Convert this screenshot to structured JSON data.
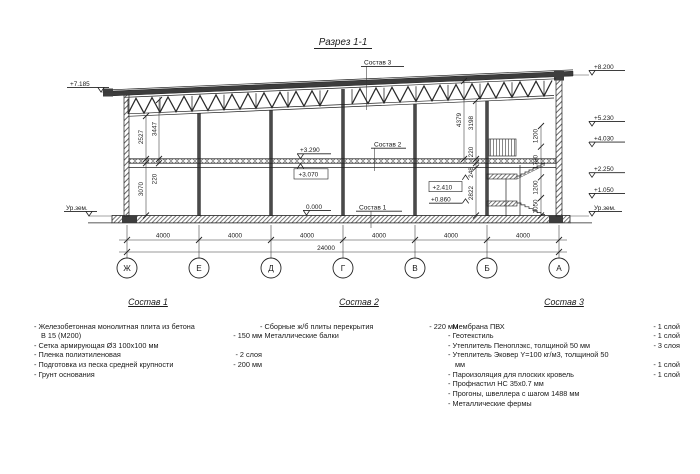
{
  "title": "Разрез 1-1",
  "colors": {
    "line": "#1f1f1f",
    "dark_fill": "#3d3d3d",
    "background": "#ffffff"
  },
  "drawing": {
    "marks": {
      "left_roof": "+7.185",
      "left_ground": "Ур.зем.",
      "right": [
        "+8.200",
        "+5.230",
        "+4.030",
        "+2.250",
        "+1.050",
        "Ур.зем."
      ],
      "slab_top": "+3.290",
      "slab_bottom": "+3.070",
      "floor_zero": "0.000",
      "stair_upper": "+2.410",
      "stair_lower": "+0.860"
    },
    "leader_labels": {
      "sostav1": "Состав 1",
      "sostav2": "Состав 2",
      "sostav3": "Состав 3"
    },
    "dims": {
      "left": [
        "2527",
        "3447",
        "220",
        "3070"
      ],
      "right_inner": [
        "4379",
        "3198",
        "220",
        "248",
        "2822"
      ],
      "right_wall": [
        "1200",
        "1780",
        "1200",
        "1050"
      ],
      "bays": [
        "4000",
        "4000",
        "4000",
        "4000",
        "4000",
        "4000"
      ],
      "total": "24000"
    },
    "axes": [
      "Ж",
      "Е",
      "Д",
      "Г",
      "В",
      "Б",
      "А"
    ]
  },
  "compositions": [
    {
      "title": "Состав 1",
      "items": [
        {
          "text": "- Железобетонная  монолитная плита из бетона В 15 (М200)",
          "value": "- 150 мм"
        },
        {
          "text": "- Сетка армирующая Ø3 100х100 мм",
          "value": ""
        },
        {
          "text": "- Пленка полиэтиленовая",
          "value": "- 2 слоя"
        },
        {
          "text": "- Подготовка из песка средней крупности",
          "value": "- 200 мм"
        },
        {
          "text": "- Грунт основания",
          "value": ""
        }
      ]
    },
    {
      "title": "Состав 2",
      "items": [
        {
          "text": "- Сборные ж/б плиты перекрытия",
          "value": "- 220 мм"
        },
        {
          "text": "- Металлические балки",
          "value": ""
        }
      ]
    },
    {
      "title": "Состав 3",
      "items": [
        {
          "text": "- Мембрана ПВХ",
          "value": "- 1 слой"
        },
        {
          "text": "- Геотекстиль",
          "value": "- 1 слой"
        },
        {
          "text": "- Утеплитель Пеноплэкс, толщиной 50 мм",
          "value": "- 3 слоя"
        },
        {
          "text": "- Утеплитель Эковер Y=100 кг/м3, толщиной 50 мм",
          "value": "- 1 слой"
        },
        {
          "text": "- Пароизоляция для плоских кровель",
          "value": "- 1 слой"
        },
        {
          "text": "- Профнастил НС 35х0.7 мм",
          "value": ""
        },
        {
          "text": "- Прогоны, швеллера с шагом 1488 мм",
          "value": ""
        },
        {
          "text": "- Металлические фермы",
          "value": ""
        }
      ]
    }
  ]
}
